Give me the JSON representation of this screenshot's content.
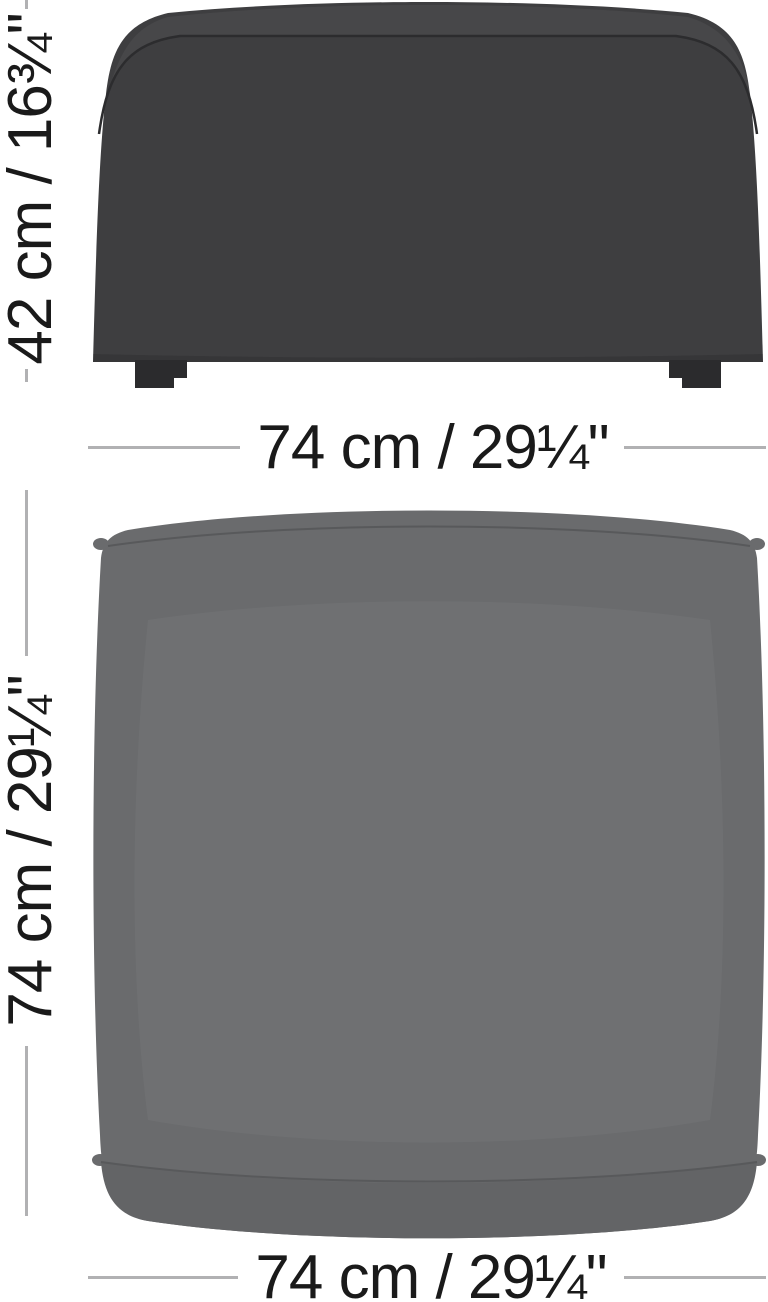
{
  "page": {
    "title": "Ottoman / pouf product dimension diagram",
    "background": "#ffffff"
  },
  "views": {
    "front": {
      "name": "ottoman front view",
      "body_color": "#3e3e40",
      "seam_color": "#2c2c2e",
      "feet_color": "#2b2b2d"
    },
    "top": {
      "name": "ottoman top view",
      "body_color": "#6a6b6d",
      "skirt_color": "#636466",
      "seam_color": "#58595b"
    }
  },
  "dimensions": {
    "front_height": {
      "label": "42 cm / 16¾\"",
      "orientation": "vertical"
    },
    "front_width": {
      "label": "74 cm / 29¼\"",
      "orientation": "horizontal"
    },
    "top_depth": {
      "label": "74 cm / 29¼\"",
      "orientation": "vertical"
    },
    "top_width": {
      "label": "74 cm / 29¼\"",
      "orientation": "horizontal"
    }
  },
  "style": {
    "dimension_line_color": "#b1b1b3",
    "label_color": "#1a1a1a"
  }
}
